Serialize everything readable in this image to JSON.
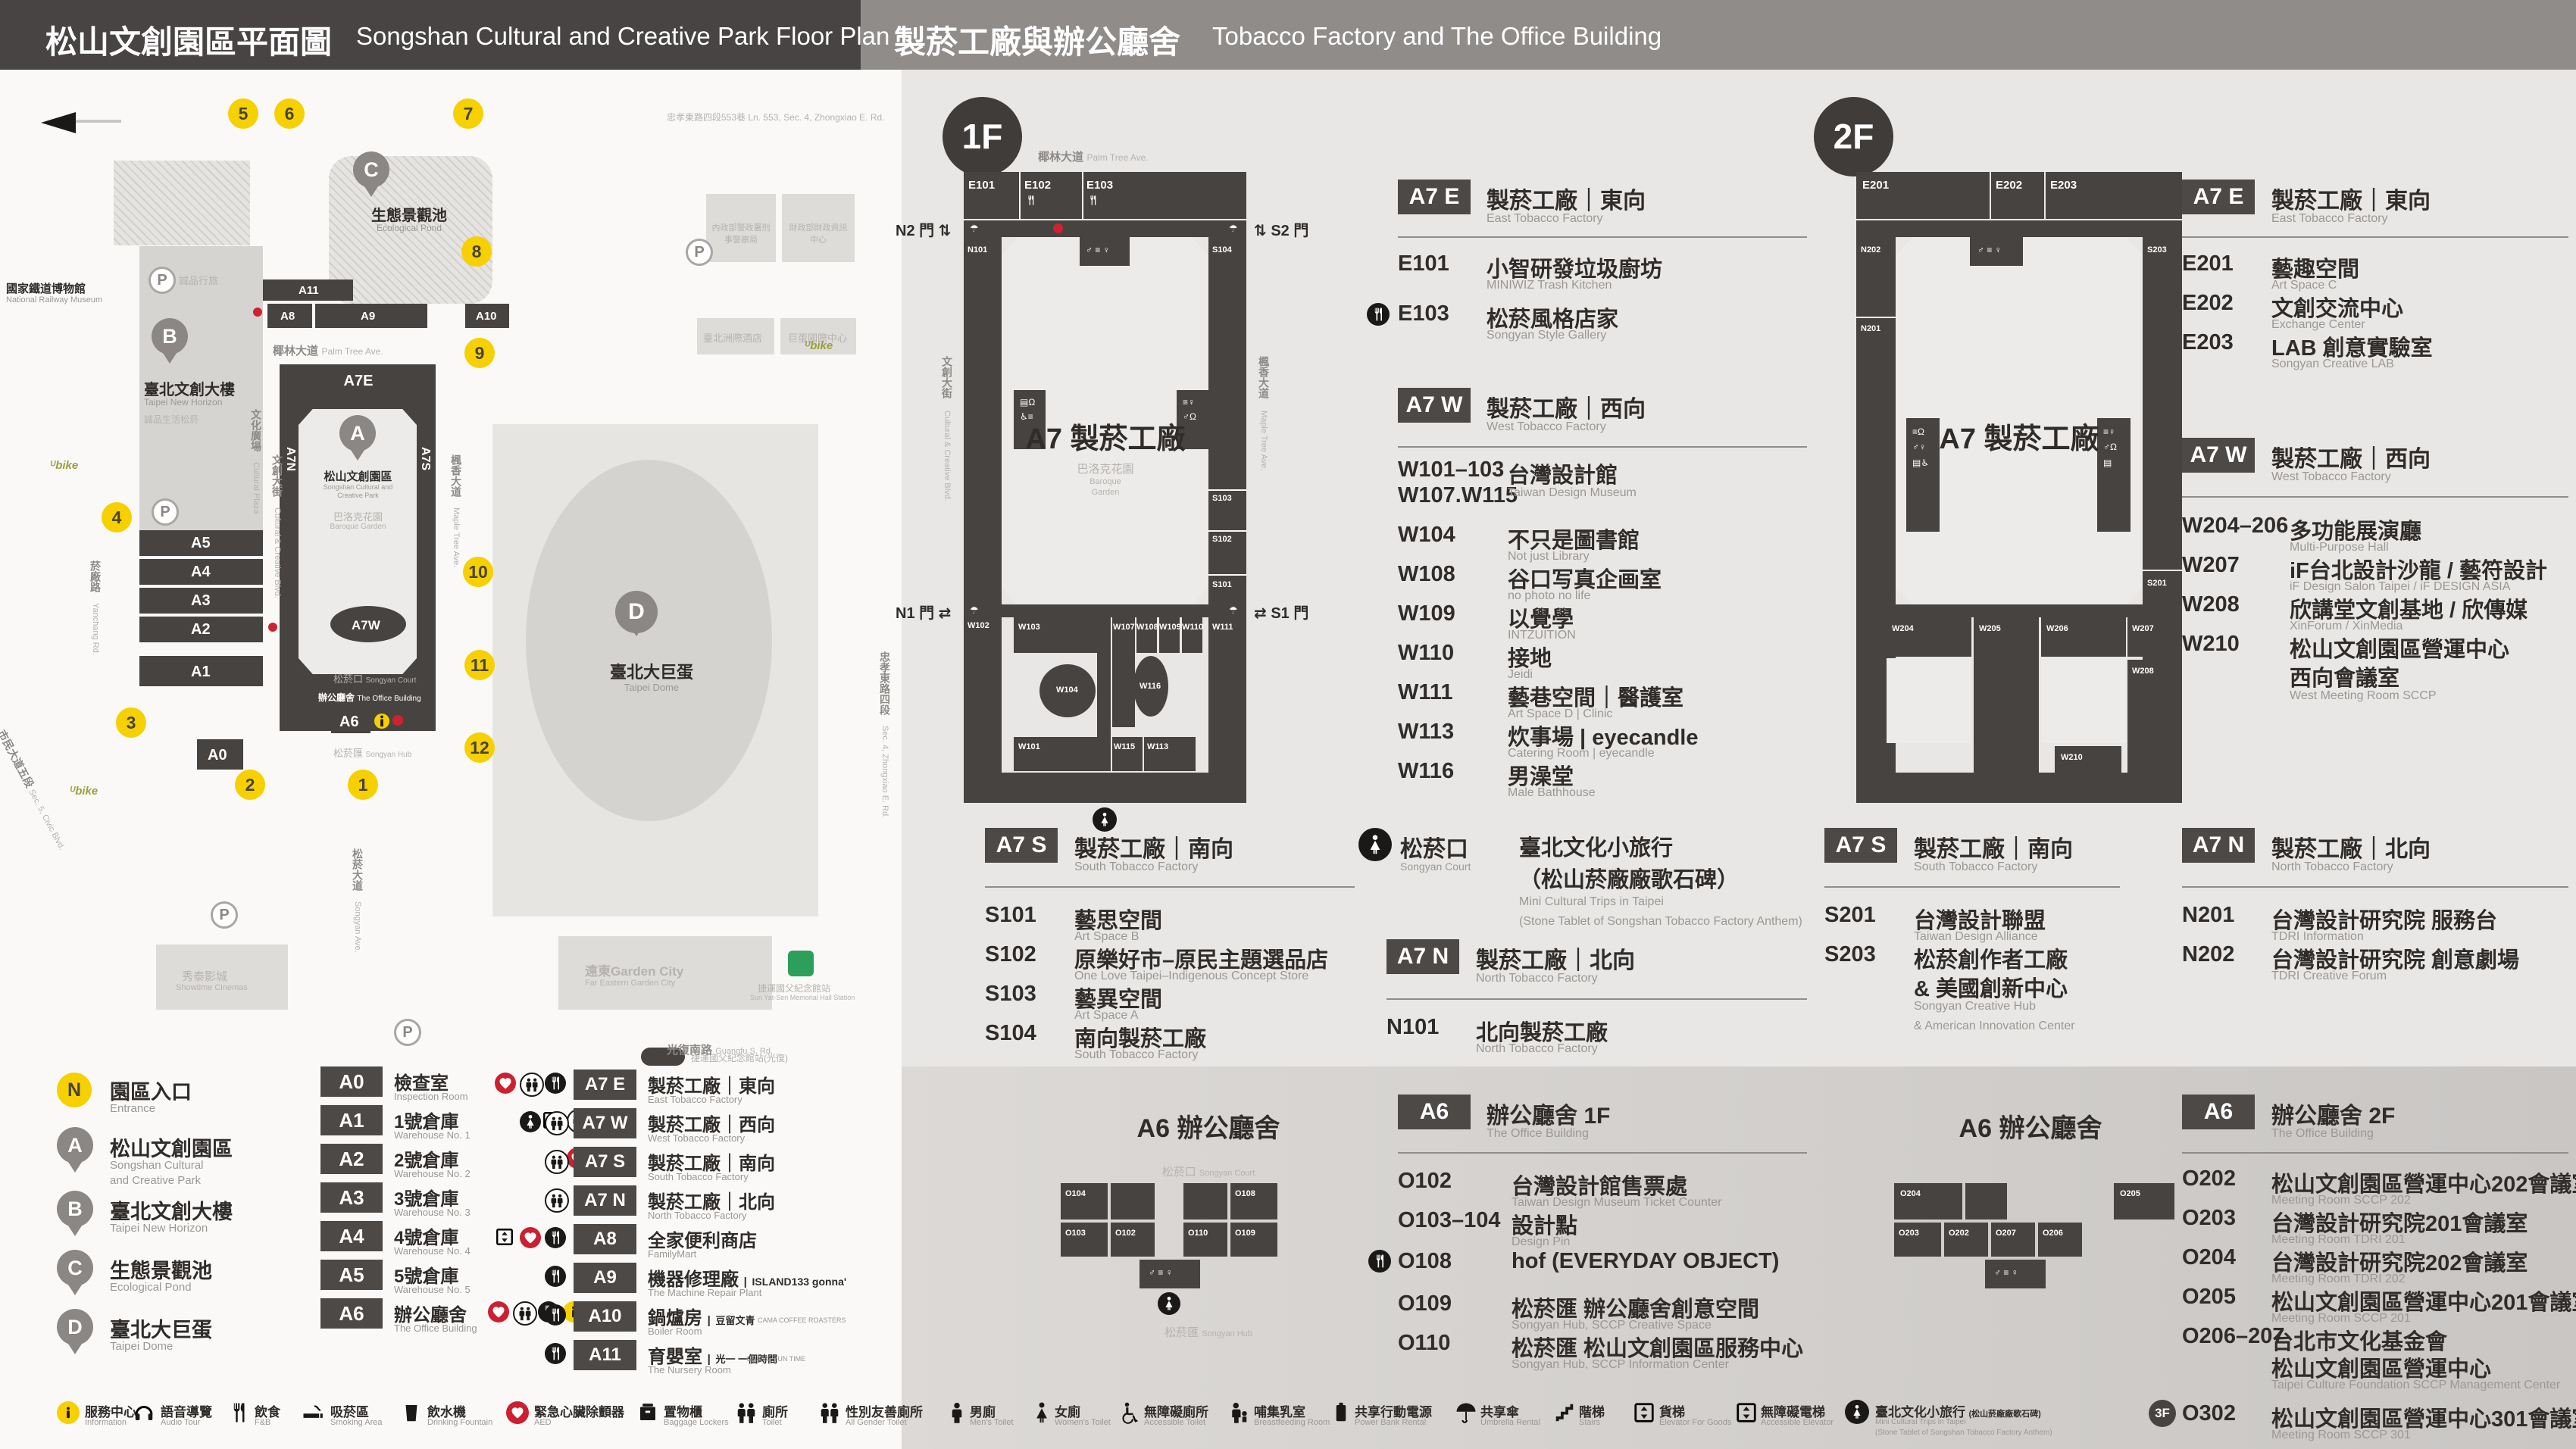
{
  "header": {
    "left_zh": "松山文創園區平面圖",
    "left_en": "Songshan Cultural and Creative Park Floor Plan",
    "right_zh": "製菸工廠與辦公廳舍",
    "right_en": "Tobacco Factory and The Office Building"
  },
  "park": {
    "museum_zh": "國家鐵道博物館",
    "museum_en": "National Railway Museum",
    "lane_zh": "忠孝東路四段553巷",
    "lane_en": "Ln. 553, Sec. 4, Zhongxiao E. Rd.",
    "gov1_zh": "內政部警政署刑事警察局",
    "gov2_zh": "財政部財政資訊中心",
    "hotel_zh": "臺北洲際酒店",
    "dome_intl_zh": "巨蛋國際中心",
    "eslite_hotel_zh": "誠品行旅",
    "b_zh": "臺北文創大樓",
    "b_en": "Taipei New Horizon",
    "b_sub_zh": "誠品生活松菸",
    "plaza_zh": "文化廣場",
    "plaza_en": "Cultural Plaza",
    "pond_zh": "生態景觀池",
    "pond_en": "Ecological Pond",
    "dome_zh": "臺北大巨蛋",
    "dome_en": "Taipei Dome",
    "sccp_zh": "松山文創園區",
    "sccp_en1": "Songshan Cultural and",
    "sccp_en2": "Creative Park",
    "garden_zh": "巴洛克花園",
    "garden_en1": "Baroque",
    "garden_en2": "Garden",
    "a7e": "A7E",
    "a7n": "A7N",
    "a7s": "A7S",
    "a7w": "A7W",
    "office_zh": "辦公廳舍",
    "office_en": "The Office Building",
    "court_zh": "松菸口",
    "court_en": "Songyan Court",
    "hub_zh": "松菸匯",
    "hub_en": "Songyan Hub",
    "palm_zh": "椰林大道",
    "palm_en": "Palm Tree Ave.",
    "cc_zh": "文創大街",
    "cc_en": "Cultural & Creative Blvd.",
    "maple_zh": "楓香大道",
    "maple_en": "Maple Tree Ave.",
    "yanchang_zh": "菸廠路",
    "yanchang_en": "Yanchang Rd.",
    "civic_zh": "市民大道五段",
    "civic_en": "Sec. 5, Civic Blvd.",
    "sy_ave_zh": "松菸大道",
    "sy_ave_en": "Songyan Ave.",
    "guangfu_zh": "光復南路",
    "guangfu_en": "Guangfu S. Rd.",
    "zhongxiao_zh": "忠孝東路四段",
    "zhongxiao_en": "Sec. 4, Zhongxiao E. Rd.",
    "garden_city_zh": "遠東Garden City",
    "garden_city_en": "Far Eastern Garden City",
    "showtime_zh": "秀泰影城",
    "showtime_en": "Showtime Cinemas",
    "mrt_zh": "捷運國父紀念館站",
    "mrt_en": "Sun Yat-Sen Memorial Hall Station",
    "mrt2_zh": "捷運國父紀念館站(光復)",
    "blocks": {
      "a11": "A11",
      "a10": "A10",
      "a9": "A9",
      "a8": "A8",
      "a5": "A5",
      "a4": "A4",
      "a3": "A3",
      "a2": "A2",
      "a1": "A1",
      "a0": "A0",
      "a6": "A6"
    },
    "pins": {
      "a": "A",
      "b": "B",
      "c": "C",
      "d": "D"
    },
    "nums": [
      "1",
      "2",
      "3",
      "4",
      "5",
      "6",
      "7",
      "8",
      "9",
      "10",
      "11",
      "12"
    ],
    "p": "P"
  },
  "legend": {
    "places": [
      {
        "k": "N",
        "zh": "園區入口",
        "en": "Entrance"
      },
      {
        "k": "A",
        "zh": "松山文創園區",
        "en1": "Songshan Cultural",
        "en2": "and Creative Park"
      },
      {
        "k": "B",
        "zh": "臺北文創大樓",
        "en": "Taipei New Horizon"
      },
      {
        "k": "C",
        "zh": "生態景觀池",
        "en": "Ecological Pond"
      },
      {
        "k": "D",
        "zh": "臺北大巨蛋",
        "en": "Taipei Dome"
      }
    ],
    "left": [
      {
        "c": "A0",
        "zh": "檢查室",
        "en": "Inspection Room",
        "icons": []
      },
      {
        "c": "A1",
        "zh": "1號倉庫",
        "en": "Warehouse No. 1",
        "icons": [
          "goods-elevator",
          "toilet"
        ]
      },
      {
        "c": "A2",
        "zh": "2號倉庫",
        "en": "Warehouse No. 2",
        "icons": [
          "aed"
        ]
      },
      {
        "c": "A3",
        "zh": "3號倉庫",
        "en": "Warehouse No. 3",
        "icons": []
      },
      {
        "c": "A4",
        "zh": "4號倉庫",
        "en": "Warehouse No. 4",
        "icons": []
      },
      {
        "c": "A5",
        "zh": "5號倉庫",
        "en": "Warehouse No. 5",
        "icons": []
      },
      {
        "c": "A6",
        "zh": "辦公廳舍",
        "en": "The Office Building",
        "icons": [
          "aed",
          "toilet",
          "fnb",
          "info"
        ]
      }
    ],
    "right": [
      {
        "c": "A7 E",
        "zh": "製菸工廠｜東向",
        "en": "East Tobacco Factory",
        "icons": [
          "aed",
          "toilet",
          "fnb"
        ]
      },
      {
        "c": "A7 W",
        "zh": "製菸工廠｜西向",
        "en": "West Tobacco Factory",
        "icons": [
          "trip",
          "toilet"
        ]
      },
      {
        "c": "A7 S",
        "zh": "製菸工廠｜南向",
        "en": "South Tobacco Factory",
        "icons": [
          "toilet"
        ]
      },
      {
        "c": "A7 N",
        "zh": "製菸工廠｜北向",
        "en": "North Tobacco Factory",
        "icons": [
          "toilet"
        ]
      },
      {
        "c": "A8",
        "zh": "全家便利商店",
        "en": "FamilyMart",
        "icons": [
          "goods-elevator",
          "aed",
          "fnb"
        ]
      },
      {
        "c": "A9",
        "zh": "機器修理廠",
        "p1": "ISLAND133 gonna'",
        "p2": "ISLAND133 gonna'",
        "en": "The Machine Repair Plant",
        "icons": [
          "fnb"
        ]
      },
      {
        "c": "A10",
        "zh": "鍋爐房",
        "p1": "豆留文青",
        "p2": "CAMA COFFEE ROASTERS",
        "en": "Boiler Room",
        "icons": [
          "fnb"
        ]
      },
      {
        "c": "A11",
        "zh": "育嬰室",
        "p1": "光一 一個時間",
        "p2": "GUANG YUN TIME",
        "en": "The Nursery Room",
        "icons": [
          "fnb"
        ]
      }
    ]
  },
  "f1": {
    "badge": "1F",
    "gates": {
      "n2": "N2 門",
      "s2": "S2 門",
      "n1": "N1 門",
      "s1": "S1 門"
    },
    "center": "A7 製菸工廠",
    "rooms": {
      "e101": "E101",
      "e102": "E102",
      "e103": "E103",
      "n101": "N101",
      "s104": "S104",
      "s103": "S103",
      "s102": "S102",
      "s101": "S101",
      "w102": "W102",
      "w103": "W103",
      "w104": "W104",
      "w107": "W107",
      "w108": "W108",
      "w109": "W109",
      "w110": "W110",
      "w111": "W111",
      "w101": "W101",
      "w115": "W115",
      "w113": "W113",
      "w116": "W116"
    },
    "a7e": {
      "badge": "A7 E",
      "zh": "製菸工廠｜東向",
      "en": "East Tobacco Factory",
      "rows": [
        {
          "c": "E101",
          "zh": "小智研發垃圾廚坊",
          "en": "MINIWIZ Trash Kitchen"
        },
        {
          "c": "E103",
          "zh": "松菸風格店家",
          "en": "Songyan Style Gallery"
        }
      ]
    },
    "a7w": {
      "badge": "A7 W",
      "zh": "製菸工廠｜西向",
      "en": "West Tobacco Factory",
      "rows": [
        {
          "c": "W101–103",
          "c2": "W107.W115",
          "zh": "台灣設計館",
          "en": "Taiwan Design Museum"
        },
        {
          "c": "W104",
          "zh": "不只是圖書館",
          "en": "Not just Library"
        },
        {
          "c": "W108",
          "zh": "谷口写真企画室",
          "en": "no photo no life"
        },
        {
          "c": "W109",
          "zh": "以覺學",
          "en": "INTZUITION"
        },
        {
          "c": "W110",
          "zh": "接地",
          "en": "Jeidi"
        },
        {
          "c": "W111",
          "zh": "藝巷空間｜醫護室",
          "en": "Art Space D | Clinic"
        },
        {
          "c": "W113",
          "zh": "炊事場 | eyecandle",
          "en": "Catering Room | eyecandle"
        },
        {
          "c": "W116",
          "zh": "男澡堂",
          "en": "Male Bathhouse"
        }
      ]
    },
    "a7s": {
      "badge": "A7 S",
      "zh": "製菸工廠｜南向",
      "en": "South Tobacco Factory",
      "rows": [
        {
          "c": "S101",
          "zh": "藝思空間",
          "en": "Art Space B"
        },
        {
          "c": "S102",
          "zh": "原樂好市–原民主題選品店",
          "en": "One Love Taipei–Indigenous Concept Store"
        },
        {
          "c": "S103",
          "zh": "藝異空間",
          "en": "Art Space A"
        },
        {
          "c": "S104",
          "zh": "南向製菸工廠",
          "en": "South Tobacco Factory"
        }
      ]
    },
    "trip": {
      "zh": "松菸口",
      "en": "Songyan Court",
      "t1": "臺北文化小旅行",
      "t2": "（松山菸廠廠歌石碑）",
      "e1": "Mini Cultural Trips in Taipei",
      "e2": "(Stone Tablet of Songshan Tobacco Factory Anthem)"
    },
    "a7n": {
      "badge": "A7 N",
      "zh": "製菸工廠｜北向",
      "en": "North Tobacco Factory",
      "rows": [
        {
          "c": "N101",
          "zh": "北向製菸工廠",
          "en": "North Tobacco Factory"
        }
      ]
    },
    "a6": {
      "badge": "A6",
      "zh": "辦公廳舍 1F",
      "en": "The Office Building",
      "map_title": "A6 辦公廳舍",
      "rooms": {
        "o104": "O104",
        "o108": "O108",
        "o103": "O103",
        "o102": "O102",
        "o110": "O110",
        "o109": "O109"
      },
      "rows": [
        {
          "c": "O102",
          "zh": "台灣設計館售票處",
          "en": "Taiwan Design Museum Ticket Counter"
        },
        {
          "c": "O103–104",
          "zh": "設計點",
          "en": "Design Pin"
        },
        {
          "c": "O108",
          "zh": "hof (EVERYDAY OBJECT)",
          "en": ""
        },
        {
          "c": "O109",
          "zh": "松菸匯 辦公廳舍創意空間",
          "en": "Songyan Hub, SCCP Creative Space"
        },
        {
          "c": "O110",
          "zh": "松菸匯 松山文創園區服務中心",
          "en": "Songyan Hub, SCCP Information Center"
        }
      ]
    }
  },
  "f2": {
    "badge": "2F",
    "center": "A7 製菸工廠",
    "rooms": {
      "e201": "E201",
      "e202": "E202",
      "e203": "E203",
      "n202": "N202",
      "n201": "N201",
      "s203": "S203",
      "s201": "S201",
      "w204": "W204",
      "w205": "W205",
      "w206": "W206",
      "w207": "W207",
      "w208": "W208",
      "w210": "W210"
    },
    "a7e": {
      "badge": "A7 E",
      "zh": "製菸工廠｜東向",
      "en": "East Tobacco Factory",
      "rows": [
        {
          "c": "E201",
          "zh": "藝趣空間",
          "en": "Art Space C"
        },
        {
          "c": "E202",
          "zh": "文創交流中心",
          "en": "Exchange Center"
        },
        {
          "c": "E203",
          "zh": "LAB 創意實驗室",
          "en": "Songyan Creative LAB"
        }
      ]
    },
    "a7w": {
      "badge": "A7 W",
      "zh": "製菸工廠｜西向",
      "en": "West Tobacco Factory",
      "rows": [
        {
          "c": "W204–206",
          "zh": "多功能展演廳",
          "en": "Multi-Purpose Hall"
        },
        {
          "c": "W207",
          "zh": "iF台北設計沙龍 / 藝符設計",
          "en": "iF Design Salon Taipei / iF DESIGN ASIA"
        },
        {
          "c": "W208",
          "zh": "欣講堂文創基地 / 欣傳媒",
          "en": "XinForum / XinMedia"
        },
        {
          "c": "W210",
          "zh": "松山文創園區營運中心",
          "zh2": "西向會議室",
          "en": "West Meeting Room SCCP"
        }
      ]
    },
    "a7s": {
      "badge": "A7 S",
      "zh": "製菸工廠｜南向",
      "en": "South Tobacco Factory",
      "rows": [
        {
          "c": "S201",
          "zh": "台灣設計聯盟",
          "en": "Taiwan Design Alliance"
        },
        {
          "c": "S203",
          "zh": "松菸創作者工廠",
          "zh2": "& 美國創新中心",
          "en": "Songyan Creative Hub",
          "en2": "& American Innovation Center"
        }
      ]
    },
    "a7n": {
      "badge": "A7 N",
      "zh": "製菸工廠｜北向",
      "en": "North Tobacco Factory",
      "rows": [
        {
          "c": "N201",
          "zh": "台灣設計研究院 服務台",
          "en": "TDRI Information"
        },
        {
          "c": "N202",
          "zh": "台灣設計研究院 創意劇場",
          "en": "TDRI Creative Forum"
        }
      ]
    },
    "a6": {
      "badge": "A6",
      "zh": "辦公廳舍 2F",
      "en": "The Office Building",
      "map_title": "A6 辦公廳舍",
      "rooms": {
        "o204": "O204",
        "o205": "O205",
        "o203": "O203",
        "o202": "O202",
        "o207": "O207",
        "o206": "O206"
      },
      "rows": [
        {
          "c": "O202",
          "zh": "松山文創園區營運中心202會議室",
          "en": "Meeting Room SCCP 202"
        },
        {
          "c": "O203",
          "zh": "台灣設計研究院201會議室",
          "en": "Meeting Room TDRI 201"
        },
        {
          "c": "O204",
          "zh": "台灣設計研究院202會議室",
          "en": "Meeting Room TDRI 202"
        },
        {
          "c": "O205",
          "zh": "松山文創園區營運中心201會議室",
          "en": "Meeting Room SCCP 201"
        },
        {
          "c": "O206–207",
          "zh": "台北市文化基金會",
          "zh2": "松山文創園區營運中心",
          "en": "Taipei Culture Foundation SCCP Management Center"
        },
        {
          "c": "O302",
          "f": "3F",
          "zh": "松山文創園區營運中心301會議室",
          "en": "Meeting Room SCCP 301"
        }
      ]
    }
  },
  "strip": {
    "items": [
      {
        "icon": "info",
        "zh": "服務中心",
        "en": "Information"
      },
      {
        "icon": "audio-tour",
        "zh": "語音導覽",
        "en": "Audio Tour"
      },
      {
        "icon": "fnb",
        "zh": "飲食",
        "en": "F&B"
      },
      {
        "icon": "smoking",
        "zh": "吸菸區",
        "en": "Smoking Area"
      },
      {
        "icon": "drinking-fountain",
        "zh": "飲水機",
        "en": "Drinking Fountain"
      },
      {
        "icon": "aed",
        "zh": "緊急心臟除顫器",
        "en": "AED"
      },
      {
        "icon": "baggage-lockers",
        "zh": "置物櫃",
        "en": "Baggage Lockers"
      },
      {
        "icon": "toilet",
        "zh": "廁所",
        "en": "Toilet"
      },
      {
        "icon": "all-gender-toilet",
        "zh": "性別友善廁所",
        "en": "All Gender Toilet"
      },
      {
        "icon": "mens-toilet",
        "zh": "男廁",
        "en": "Men's Toilet"
      },
      {
        "icon": "womens-toilet",
        "zh": "女廁",
        "en": "Women's Toilet"
      },
      {
        "icon": "accessible-toilet",
        "zh": "無障礙廁所",
        "en": "Accessible Toilet"
      },
      {
        "icon": "breastfeeding-room",
        "zh": "哺集乳室",
        "en": "Breastfeeding Room"
      },
      {
        "icon": "power-bank",
        "zh": "共享行動電源",
        "en": "Power Bank Rental"
      },
      {
        "icon": "umbrella",
        "zh": "共享傘",
        "en": "Umbrella Rental"
      },
      {
        "icon": "stairs",
        "zh": "階梯",
        "en": "Stairs"
      },
      {
        "icon": "goods-elevator",
        "zh": "貨梯",
        "en": "Elevator For Goods"
      },
      {
        "icon": "accessible-elevator",
        "zh": "無障礙電梯",
        "en": "Accessible Elevator"
      },
      {
        "icon": "mini-cultural-trips",
        "zh": "臺北文化小旅行",
        "zh2": "(松山菸廠廠歌石碑)",
        "en": "Mini Cultural Trips in Taipei",
        "en2": "(Stone Tablet of Songshan Tobacco Factory Anthem)"
      }
    ]
  }
}
